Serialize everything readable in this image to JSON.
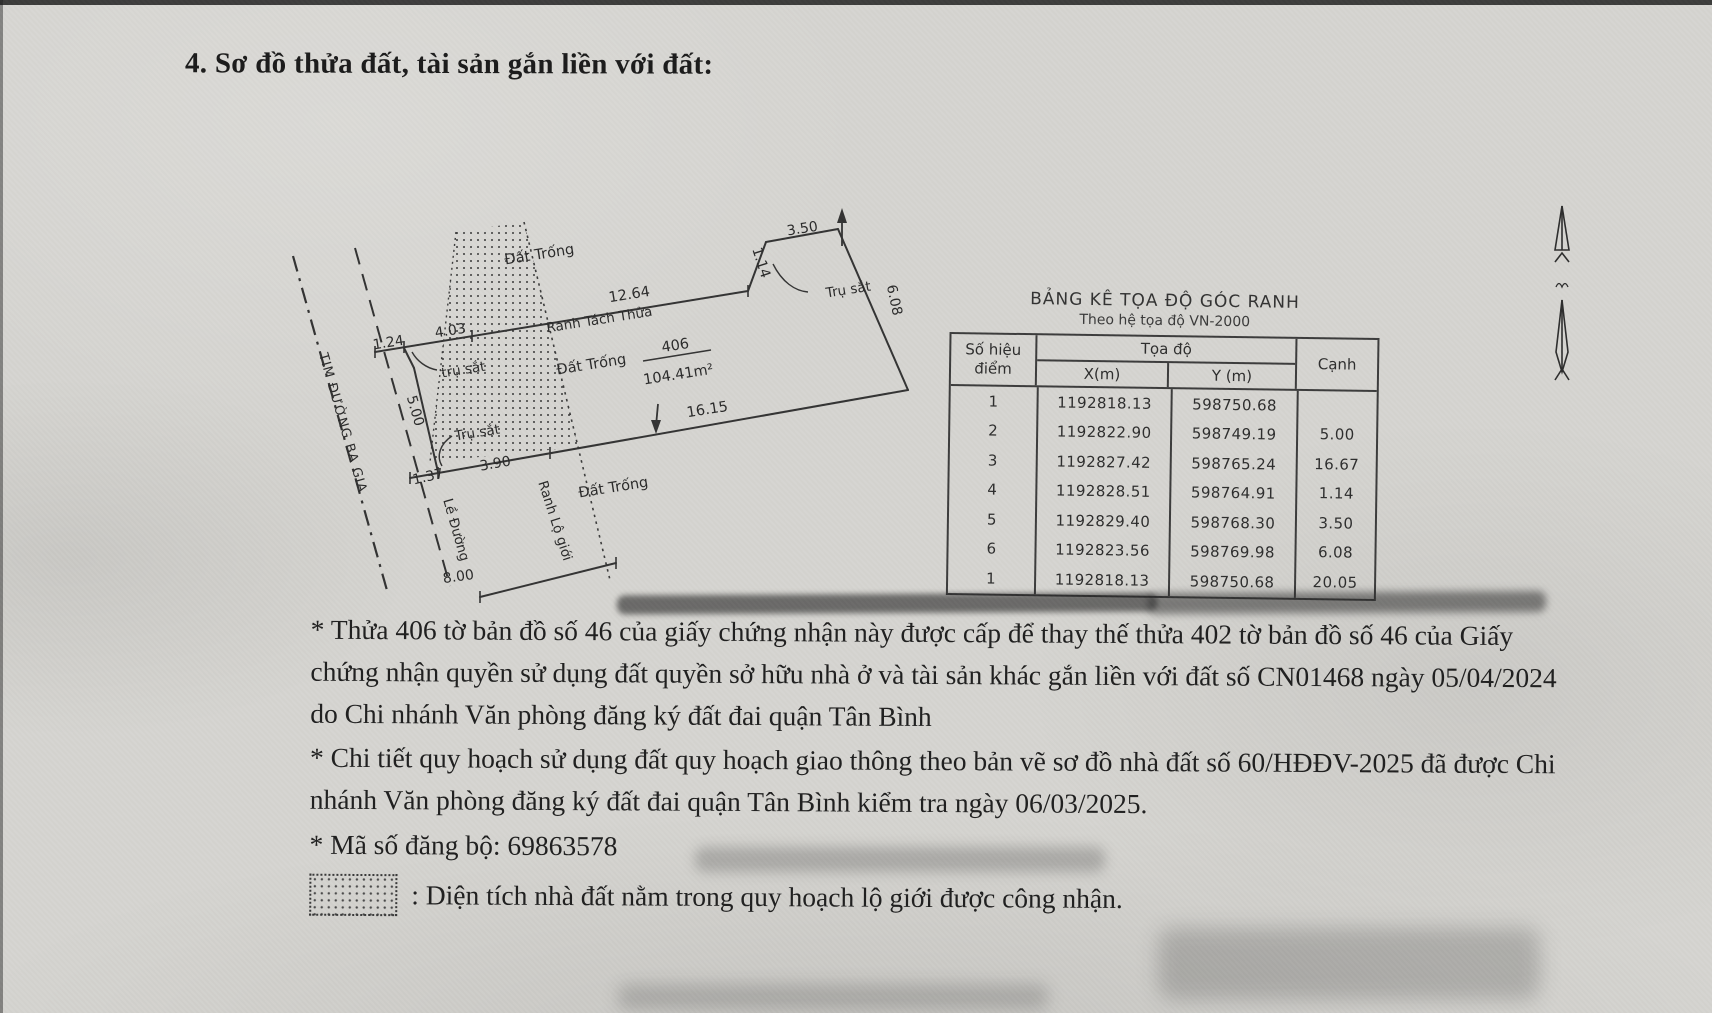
{
  "page": {
    "title": "4. Sơ đồ thửa đất, tài sản gắn liền với đất:"
  },
  "diagram": {
    "labels": {
      "dat_trong_top": "Đất Trống",
      "dat_trong_mid": "Đất Trống",
      "dat_trong_bottom": "Đất Trống",
      "ranh_tach_thua": "Ranh Tách Thửa",
      "ranh_lo_gioi": "Ranh Lộ giới",
      "le_duong": "Lề Đường",
      "tim_duong": "TIM ĐƯỜNG BA GIA",
      "tru_sat_right": "Trụ sắt",
      "tru_sat_upper": "trụ sắt",
      "tru_sat_lower": "Trụ sắt",
      "parcel_number": "406",
      "parcel_area": "104.41m²"
    },
    "measurements": {
      "m_350": "3.50",
      "m_114": "1.14",
      "m_608": "6.08",
      "m_1264": "12.64",
      "m_124": "1.24",
      "m_403": "4.03",
      "m_500": "5.00",
      "m_1615": "16.15",
      "m_137": "1.37",
      "m_390": "3.90",
      "m_800": "8.00"
    }
  },
  "table": {
    "title": "BẢNG KÊ TỌA ĐỘ GÓC RANH",
    "subtitle": "Theo hệ tọa độ VN-2000",
    "headers": {
      "point": "Số hiệu điểm",
      "coords": "Tọa độ",
      "x": "X(m)",
      "y": "Y (m)",
      "edge": "Cạnh"
    },
    "rows": [
      {
        "point": "1",
        "x": "1192818.13",
        "y": "598750.68"
      },
      {
        "point": "2",
        "x": "1192822.90",
        "y": "598749.19"
      },
      {
        "point": "3",
        "x": "1192827.42",
        "y": "598765.24"
      },
      {
        "point": "4",
        "x": "1192828.51",
        "y": "598764.91"
      },
      {
        "point": "5",
        "x": "1192829.40",
        "y": "598768.30"
      },
      {
        "point": "6",
        "x": "1192823.56",
        "y": "598769.98"
      },
      {
        "point": "1",
        "x": "1192818.13",
        "y": "598750.68"
      }
    ],
    "edges": [
      "5.00",
      "16.67",
      "1.14",
      "3.50",
      "6.08",
      "20.05"
    ]
  },
  "notes": {
    "note1": "* Thửa 406 tờ bản đồ số 46 của giấy chứng nhận này được cấp để thay thế thửa 402 tờ bản đồ số 46 của Giấy chứng nhận quyền sử dụng đất quyền sở hữu nhà ở và tài sản khác gắn liền với đất số CN01468 ngày 05/04/2024 do Chi nhánh Văn phòng đăng ký đất đai quận Tân Bình",
    "note2": "* Chi tiết quy hoạch sử dụng đất quy hoạch giao thông theo bản vẽ sơ đồ nhà đất số 60/HĐĐV-2025 đã được Chi nhánh Văn phòng đăng ký đất đai quận Tân Bình kiểm tra ngày 06/03/2025.",
    "note3": "* Mã số đăng bộ: 69863578",
    "legend": ": Diện tích nhà đất nằm trong quy hoạch lộ giới được công nhận."
  }
}
